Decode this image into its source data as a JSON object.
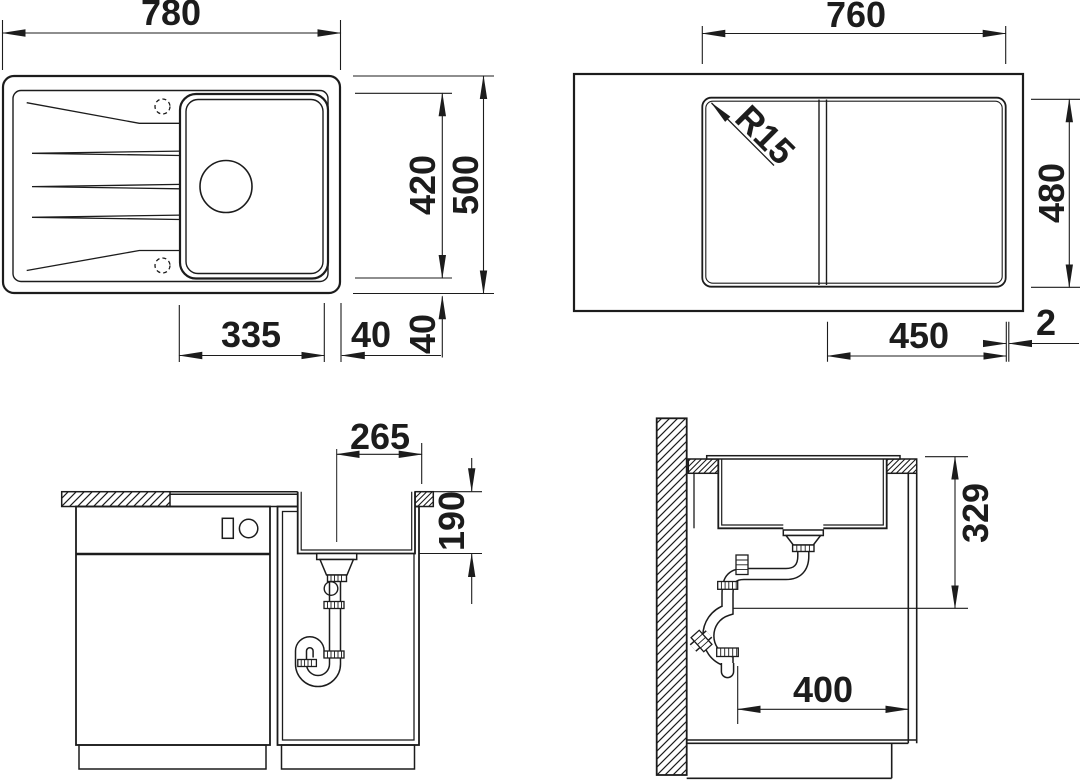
{
  "title": "Sink installation dimension drawing",
  "colors": {
    "line": "#1c1c1c",
    "bg": "#ffffff"
  },
  "views": {
    "top_left": {
      "name": "Sink top view",
      "dims": {
        "width": "780",
        "inner_depth": "420",
        "total_depth": "500",
        "bowl_width": "335",
        "bowl_to_edge": "40",
        "rim_to_edge": "40"
      }
    },
    "top_right": {
      "name": "Worktop cutout plan",
      "dims": {
        "cutout_width": "760",
        "corner_radius": "R15",
        "cutout_depth": "480",
        "bowl_section_width": "450",
        "gap": "2"
      }
    },
    "bottom_left": {
      "name": "Cabinet front section",
      "dims": {
        "drain_center_offset": "265",
        "bowl_depth": "190"
      }
    },
    "bottom_right": {
      "name": "Cabinet side section",
      "dims": {
        "drain_height": "329",
        "pipe_clearance": "400"
      }
    }
  }
}
